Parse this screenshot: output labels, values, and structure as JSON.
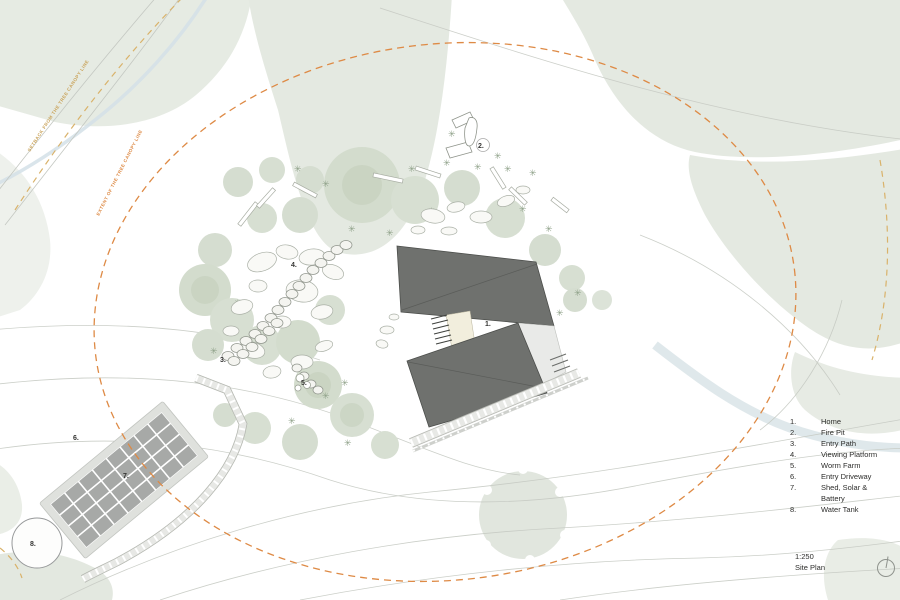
{
  "drawing": {
    "scale": "1:250",
    "name": "Site Plan"
  },
  "legend": {
    "items": [
      {
        "num": "1.",
        "label": "Home"
      },
      {
        "num": "2.",
        "label": "Fire Pit"
      },
      {
        "num": "3.",
        "label": "Entry Path"
      },
      {
        "num": "4.",
        "label": "Viewing Platform"
      },
      {
        "num": "5.",
        "label": "Worm Farm"
      },
      {
        "num": "6.",
        "label": "Entry Driveway"
      },
      {
        "num": "7.",
        "label": "Shed, Solar & Battery"
      },
      {
        "num": "8.",
        "label": "Water Tank"
      }
    ]
  },
  "plan_markers": [
    {
      "text": "1."
    },
    {
      "text": "2."
    },
    {
      "text": "3."
    },
    {
      "text": "4."
    },
    {
      "text": "5."
    },
    {
      "text": "6."
    },
    {
      "text": "7."
    },
    {
      "text": "8."
    }
  ],
  "annotations": {
    "tan_line_label": "SETBACK FROM THE TREE CANOPY LINE",
    "orange_line_label": "EXTENT OF THE TREE CANOPY LINE"
  },
  "icons": {
    "north_arrow": "north-arrow-compass"
  },
  "colors": {
    "boundary_orange": "#de8a45",
    "canopy_tan": "#d9b26a",
    "roof_gray": "#6f716e",
    "vegetation_sage": "#e4e9e1",
    "tree_sage": "#d5ddd0",
    "deck_cream": "#f2eedd",
    "solar_panel_gray": "#a7a9a7",
    "stream_blue": "#d3e1e7",
    "contour_gray": "#c6cac3"
  }
}
